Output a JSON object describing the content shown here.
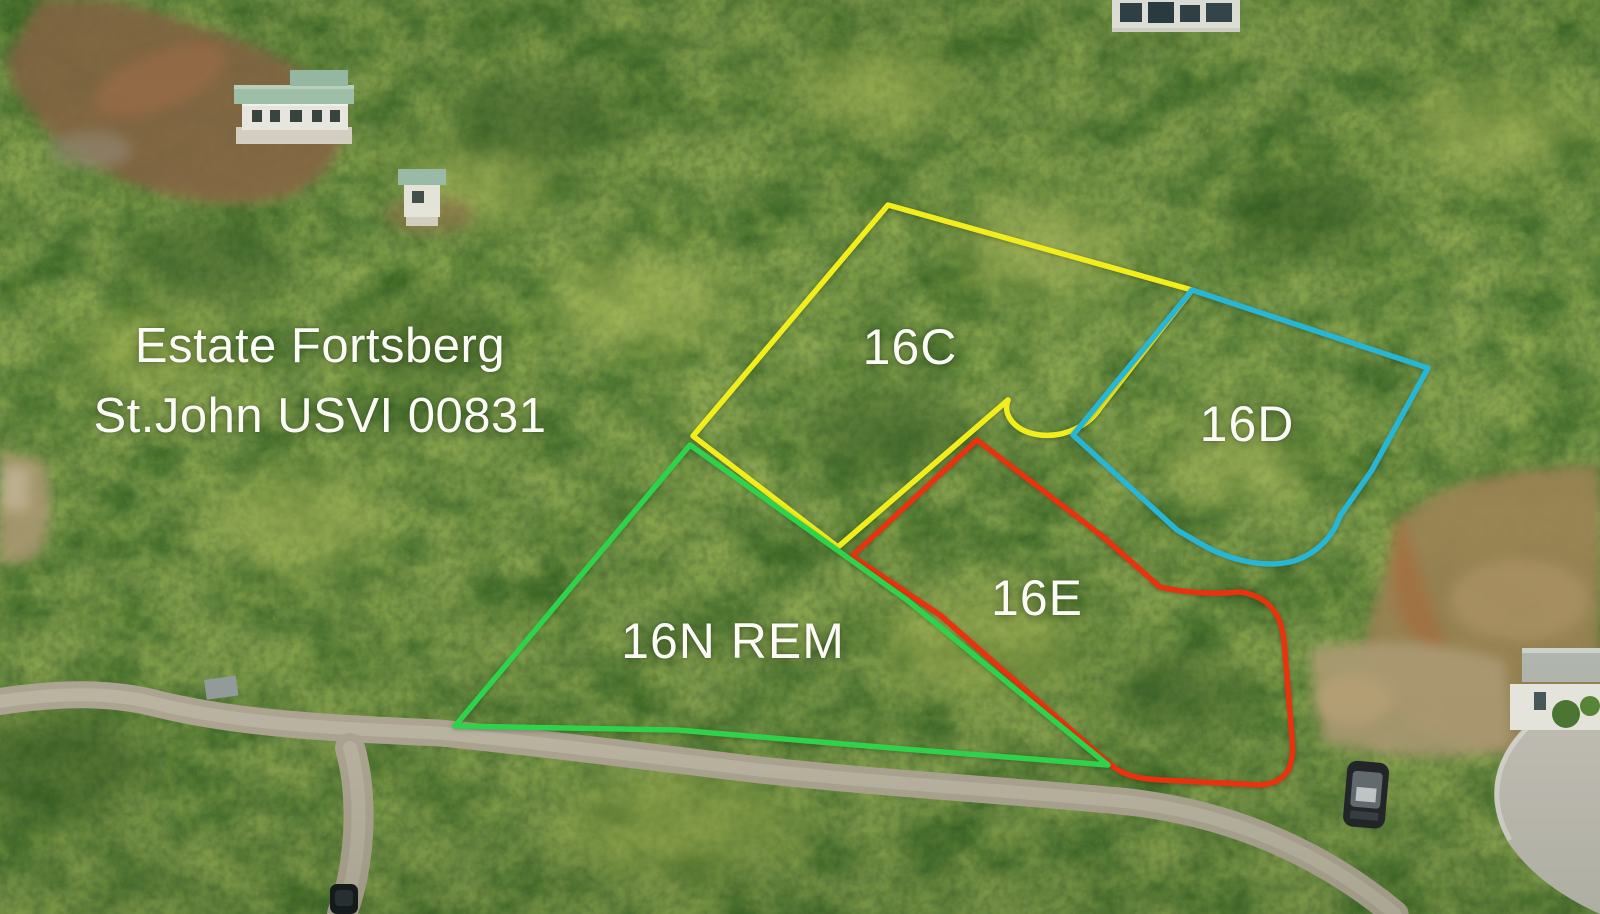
{
  "image_type": "aerial-drone-photo-with-parcel-outlines",
  "location_label": {
    "line1": "Estate Fortsberg",
    "line2": "St.John USVI 00831",
    "text_color": "#fbfbf6"
  },
  "parcels": [
    {
      "id": "16C",
      "label": "16C",
      "color": "#f2ee1c",
      "label_x": 910,
      "label_y": 347,
      "outline": "M 888 205 L 1192 290 L 1100 408 C 1090 424 1066 438 1040 435 C 1016 432 1002 416 1008 400 L 838 547 L 693 436 Z"
    },
    {
      "id": "16D",
      "label": "16D",
      "color": "#27b7d4",
      "label_x": 1247,
      "label_y": 424,
      "outline": "M 1192 290 L 1428 368 L 1372 470 L 1340 516 C 1332 539 1315 554 1294 561 C 1260 570 1222 557 1196 541 L 1177 530 L 1073 435 Z"
    },
    {
      "id": "16E",
      "label": "16E",
      "color": "#e8330e",
      "label_x": 1037,
      "label_y": 598,
      "outline": "M 977 440 L 1102 536 L 1160 587 C 1190 594 1218 594 1240 592 C 1268 596 1281 613 1284 640 L 1292 738 C 1295 768 1286 783 1260 785 L 1162 780 C 1134 779 1120 773 1110 764 L 940 615 L 852 556 Z"
    },
    {
      "id": "16N-REM",
      "label": "16N REM",
      "color": "#2ed24b",
      "label_x": 733,
      "label_y": 641,
      "outline": "M 690 445 L 907 600 L 1108 765 L 880 747 L 677 730 L 455 726 Z"
    }
  ]
}
